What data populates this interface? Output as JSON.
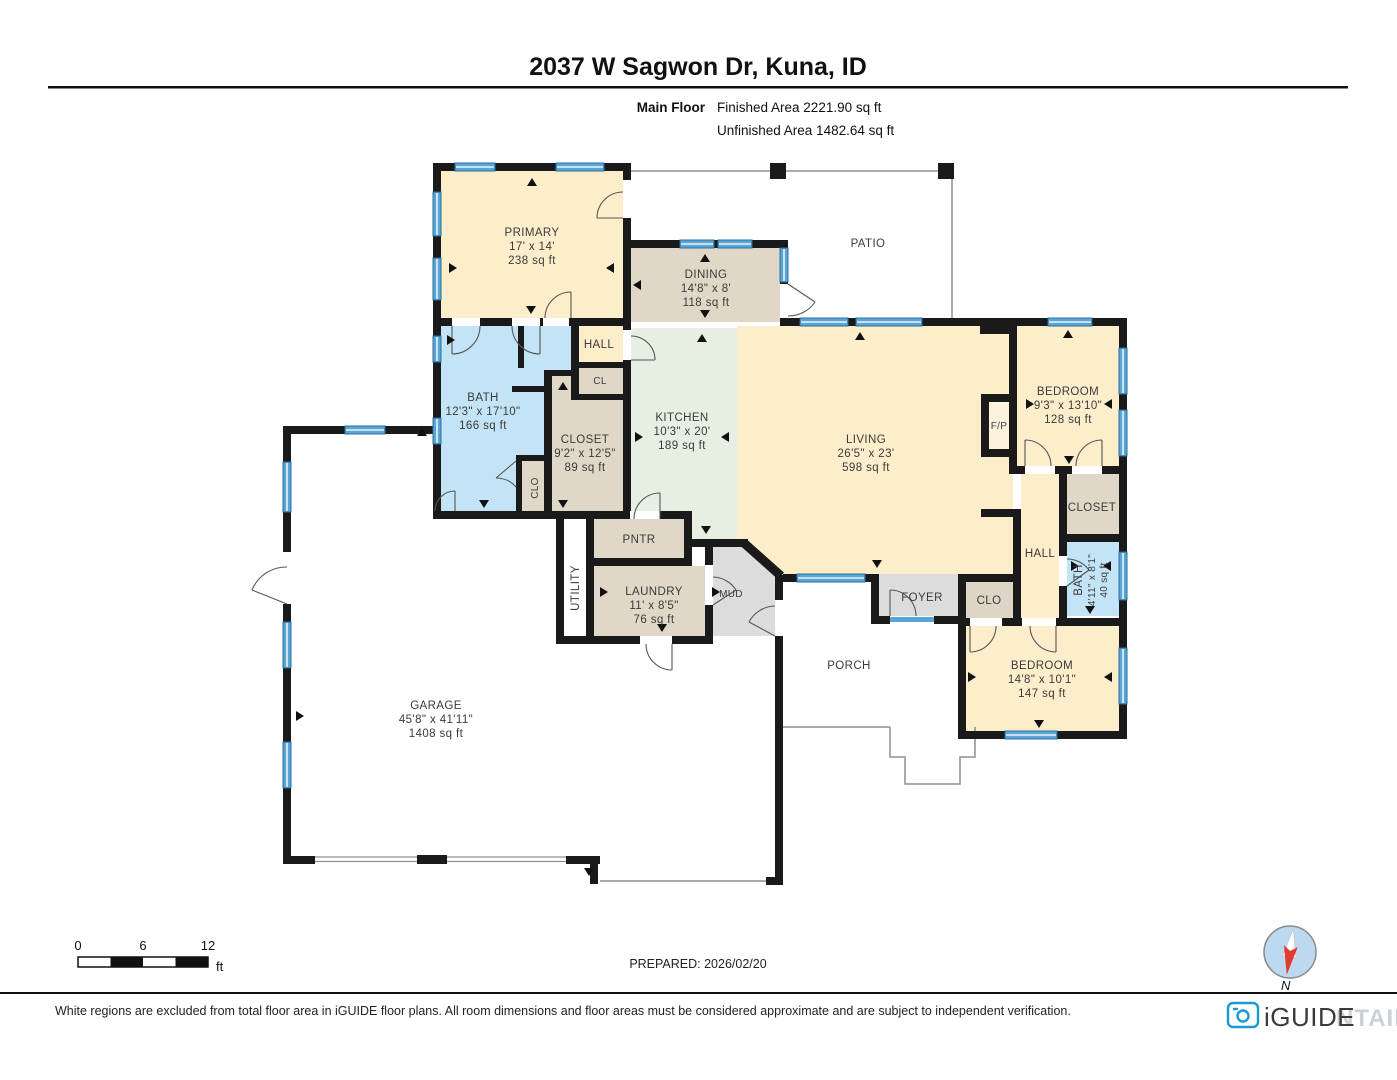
{
  "header": {
    "title": "2037 W Sagwon Dr, Kuna, ID",
    "floor_label": "Main Floor",
    "finished_area": "Finished Area 2221.90 sq ft",
    "unfinished_area": "Unfinished Area 1482.64 sq ft"
  },
  "rooms": {
    "primary": {
      "name": "PRIMARY",
      "dims": "17' x 14'",
      "area": "238 sq ft"
    },
    "dining": {
      "name": "DINING",
      "dims": "14'8\" x 8'",
      "area": "118 sq ft"
    },
    "patio": {
      "name": "PATIO"
    },
    "hall_upper": {
      "name": "HALL"
    },
    "cl": {
      "name": "CL"
    },
    "bath_primary": {
      "name": "BATH",
      "dims": "12'3\" x 17'10\"",
      "area": "166 sq ft"
    },
    "closet_primary": {
      "name": "CLOSET",
      "dims": "9'2\" x 12'5\"",
      "area": "89 sq ft"
    },
    "clo_small": {
      "name": "CLO"
    },
    "kitchen": {
      "name": "KITCHEN",
      "dims": "10'3\" x 20'",
      "area": "189 sq ft"
    },
    "living": {
      "name": "LIVING",
      "dims": "26'5\" x 23'",
      "area": "598 sq ft"
    },
    "fireplace": {
      "name": "F/P"
    },
    "bedroom_ne": {
      "name": "BEDROOM",
      "dims": "9'3\" x 13'10\"",
      "area": "128 sq ft"
    },
    "closet_ne": {
      "name": "CLOSET"
    },
    "hall_right": {
      "name": "HALL"
    },
    "bath_right": {
      "name": "BATH",
      "dims": "4'11\" x 8'1\"",
      "area": "40 sq ft"
    },
    "foyer": {
      "name": "FOYER"
    },
    "clo_right": {
      "name": "CLO"
    },
    "bedroom_se": {
      "name": "BEDROOM",
      "dims": "14'8\" x 10'1\"",
      "area": "147 sq ft"
    },
    "porch": {
      "name": "PORCH"
    },
    "pantry": {
      "name": "PNTR"
    },
    "laundry": {
      "name": "LAUNDRY",
      "dims": "11' x 8'5\"",
      "area": "76 sq ft"
    },
    "mud": {
      "name": "MUD"
    },
    "utility": {
      "name": "UTILITY"
    },
    "garage": {
      "name": "GARAGE",
      "dims": "45'8\" x 41'11\"",
      "area": "1408 sq ft"
    }
  },
  "scale_bar": {
    "tick0": "0",
    "tick6": "6",
    "tick12": "12",
    "unit": "ft"
  },
  "footer": {
    "prepared": "PREPARED: 2026/02/20",
    "disclaimer": "White regions are excluded from total floor area in iGUIDE floor plans. All room dimensions and floor areas must be considered approximate and are subject to independent verification.",
    "brand": "iGUIDE",
    "watermark": "NTAIN",
    "compass_north": "N"
  },
  "colors": {
    "wall": "#1a1a1a",
    "window_blue": "#58a6d5",
    "room_yellow": "#fdeecb",
    "room_tan": "#e0d8c6",
    "room_blue": "#c3e4f6",
    "room_green": "#e6efe2",
    "room_gray": "#dcdcdc",
    "brand_blue": "#1b9ad2",
    "compass_red": "#e03c31"
  }
}
